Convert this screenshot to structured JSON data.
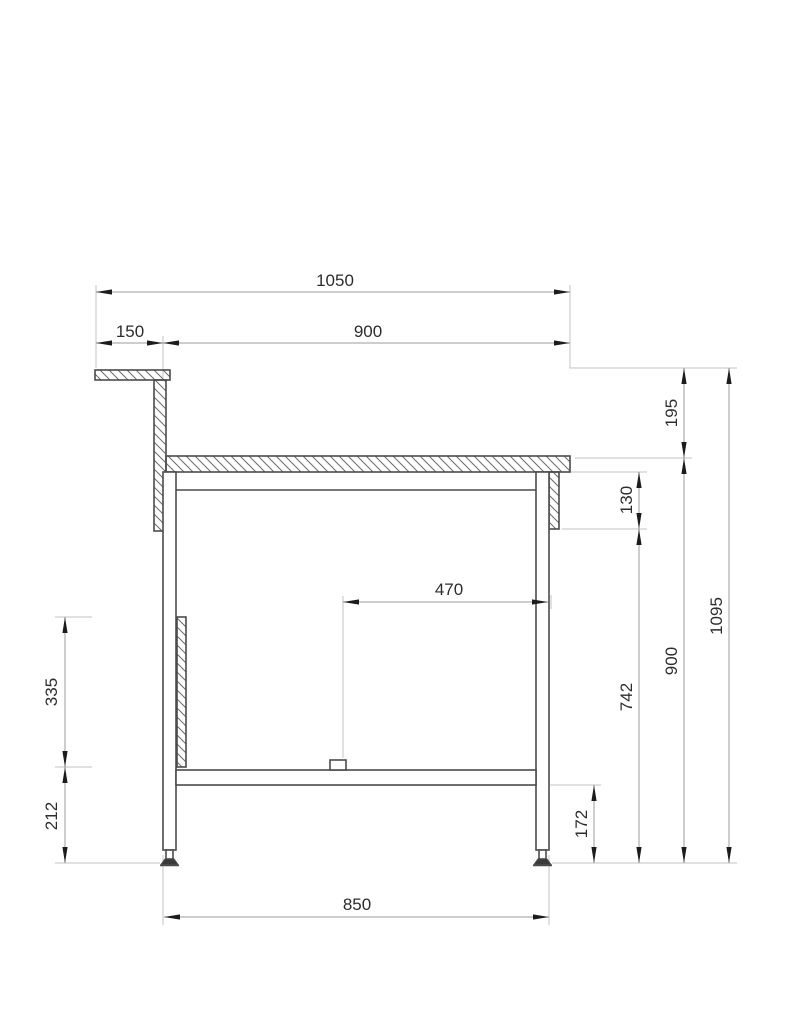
{
  "drawing": {
    "type": "technical-drawing",
    "view": "workbench-side-elevation",
    "colors": {
      "part_line": "#4b4b4b",
      "hatch_line": "#6b6b6b",
      "dimension_line": "#9b9b9b",
      "extension_line": "#c3c3c3",
      "arrow_color": "#1c1c1c",
      "text_color": "#2d2d2d",
      "paper": "#ffffff"
    },
    "dimensions": {
      "top_overall_width": "1050",
      "upstand_cap_offset": "150",
      "worktop_width": "900",
      "center_span": "470",
      "leg_span": "850",
      "upstand_above_worktop": "195",
      "apron_depth": "130",
      "under_shelf_height": "742",
      "worktop_height": "900",
      "overall_height": "1095",
      "shelf_to_floor": "172",
      "side_panel_height": "335",
      "panel_to_floor": "212"
    }
  }
}
